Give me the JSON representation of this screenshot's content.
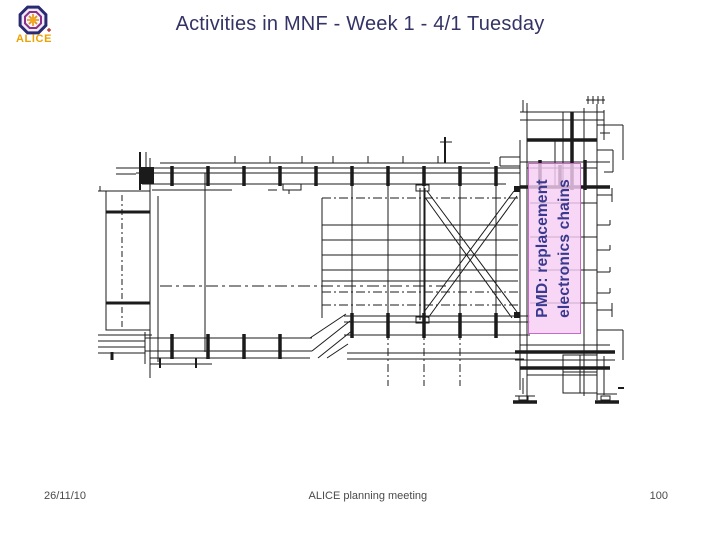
{
  "slide": {
    "title": "Activities in MNF - Week 1 - 4/1 Tuesday",
    "logo": {
      "text": "ALICE"
    },
    "diagram": {
      "label": {
        "line1": "PMD: replacement",
        "line2": "electronics chains"
      }
    },
    "footer": {
      "date": "26/11/10",
      "center": "ALICE planning meeting",
      "page": "100"
    },
    "colors": {
      "title_text": "#333366",
      "label_bg": "#f6cdf3",
      "label_border": "#c969c9",
      "label_text": "#39398f",
      "footer_text": "#4a4a4a",
      "logo_text": "#eda202",
      "drawing_lines": "#1b1b1b"
    }
  }
}
